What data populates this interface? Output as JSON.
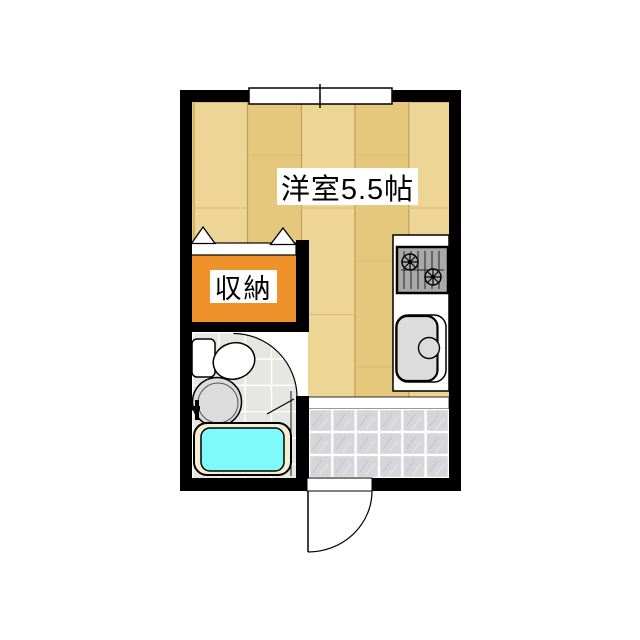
{
  "plan": {
    "title": "studio-apartment-floor-plan",
    "room_label": "洋室5.5帖",
    "closet_label": "収納"
  },
  "colors": {
    "wall": "#000000",
    "wood_light": "#EDD596",
    "wood_dark": "#E5C87C",
    "wood_seam": "#C29B52",
    "wood_joint": "#D8BA75",
    "closet": "#F0922B",
    "tub_water": "#7FFAFA",
    "tub_rim": "#F3EFD2",
    "entrance_tile": "#D6D6DA",
    "bath_floor": "#E6E6E2",
    "fixture_gray": "#DCDCDC",
    "stove_gray": "#A9A9A9",
    "line_black": "#000000",
    "white": "#FFFFFF"
  },
  "fixtures": {
    "window": "window",
    "bifold": "closet-bifold-door",
    "stove": "gas-stove-icon",
    "sink": "kitchen-sink-icon",
    "toilet": "toilet-icon",
    "washbasin": "washbasin-icon",
    "faucet": "bath-faucet-icon",
    "bathtub": "bathtub-icon",
    "entrance_tiles": "entrance-tile-floor",
    "entrance_door": "entrance-door-swing",
    "bathroom_door": "bathroom-door-swing",
    "step": "entrance-step-edge"
  }
}
